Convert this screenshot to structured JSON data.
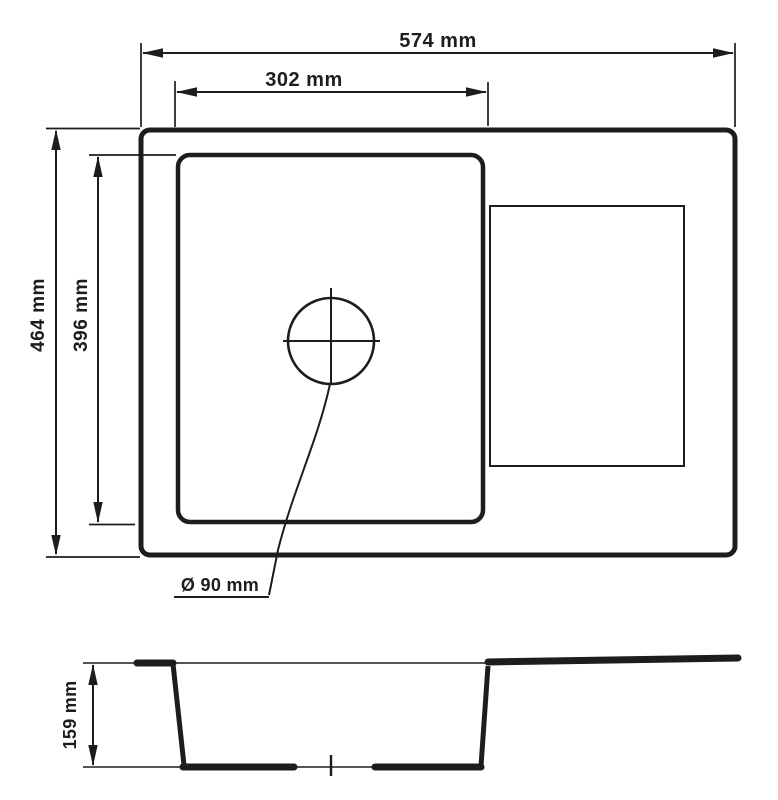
{
  "drawing": {
    "kind": "sink-dimension-drawing",
    "top_view": {
      "overall_width": "574 mm",
      "bowl_width": "302 mm",
      "overall_depth": "464 mm",
      "bowl_depth": "396 mm",
      "drain_diameter": "Ø 90 mm"
    },
    "section_view": {
      "bowl_height": "159 mm"
    },
    "colors": {
      "line": "#1d1d1b",
      "background": "#ffffff"
    }
  }
}
